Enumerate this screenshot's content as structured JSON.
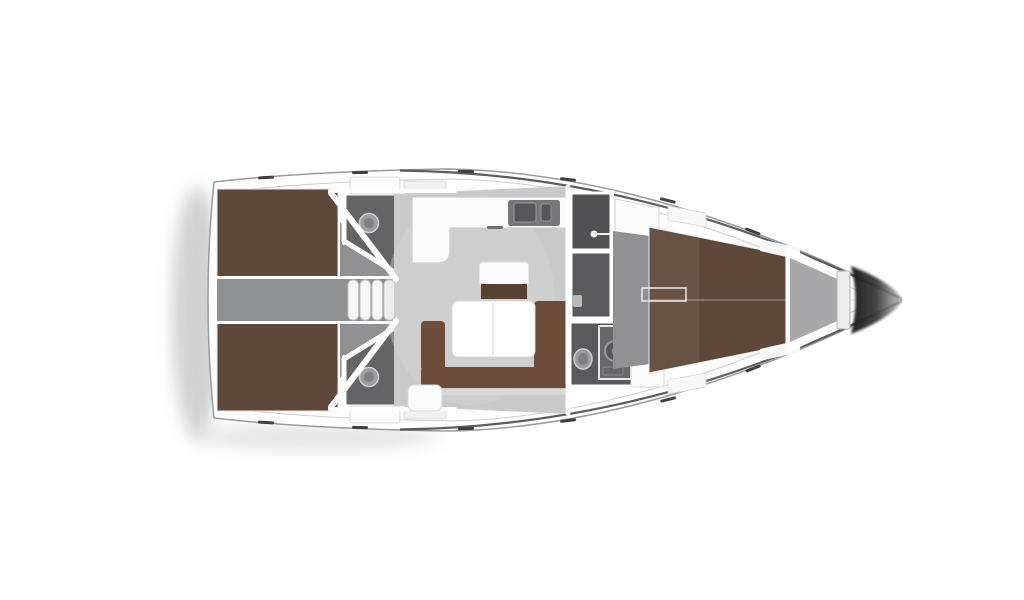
{
  "diagram": {
    "subject": "sailing-yacht-interior-floor-plan",
    "orientation": "bow-right",
    "view": "top-down"
  },
  "icons": [
    "toilet-icon",
    "sink-icon",
    "shower-icon",
    "companionway-steps-icon",
    "door-swing-icon",
    "deck-hatch-icon",
    "galley-sink-icon"
  ],
  "colors": {
    "background": "#ffffff",
    "hull": "#ffffff",
    "hull_edge": "#9a9a9a",
    "rail_dark": "#3f3f3f",
    "shadow": "#c6c6c6",
    "bed_brown": "#5f4839",
    "bed_brown_light": "#6b5242",
    "sofa_brown": "#6d4c39",
    "sofa_brown_dark": "#59402f",
    "salon_floor": "#c9c9c9",
    "salon_floor_light": "#d8d8d8",
    "cabin_floor": "#909092",
    "corridor_floor": "#8f9092",
    "entry_floor": "#87878a",
    "head_floor": "#646467",
    "shower_floor": "#515154",
    "wc_floor": "#5a5a5d",
    "locker_floor": "#a8a8aa",
    "counter_white": "#fbfbfb",
    "counter_inset": "#77777a",
    "sink_dark": "#55555a",
    "fixture_gray": "#9c9c9e",
    "fixture_inner": "#7f7f82",
    "table_white": "#ffffff",
    "step_white": "#f7f7f7",
    "shelf_white": "#f7f7f7",
    "bench_white": "#fbfbfb",
    "bow_dark": "#161616",
    "bow_mid": "#3d3d3d",
    "bow_tip": "#b7b7b7",
    "seat_trim": "#d9d9d9"
  }
}
